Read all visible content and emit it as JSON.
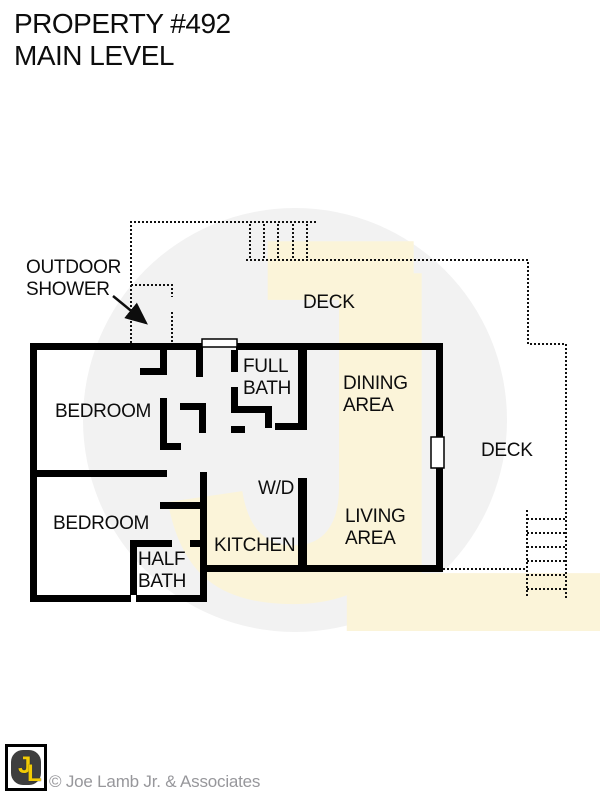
{
  "title": {
    "line1": "PROPERTY #492",
    "line2": "MAIN LEVEL"
  },
  "rooms": {
    "bedroom_top": "BEDROOM",
    "bedroom_bottom": "BEDROOM",
    "full_bath": {
      "line1": "FULL",
      "line2": "BATH"
    },
    "half_bath": {
      "line1": "HALF",
      "line2": "BATH"
    },
    "wd": "W/D",
    "kitchen": "KITCHEN",
    "dining": {
      "line1": "DINING",
      "line2": "AREA"
    },
    "living": {
      "line1": "LIVING",
      "line2": "AREA"
    },
    "deck_top": "DECK",
    "deck_right": "DECK"
  },
  "annotations": {
    "outdoor_shower": {
      "line1": "OUTDOOR",
      "line2": "SHOWER"
    }
  },
  "watermark": {
    "letter_j": "J",
    "letter_l": "L"
  },
  "footer": {
    "logo_letter_j": "J",
    "logo_letter_l": "L",
    "copyright": "© Joe Lamb Jr. & Associates"
  },
  "colors": {
    "wall": "#000000",
    "dotted_line": "#111111",
    "watermark_circle": "#f2f2f2",
    "watermark_letters": "#fbf4d9",
    "logo_yellow": "#f2cb05",
    "logo_dark": "#3e3e3e",
    "copyright_gray": "#97979b"
  }
}
